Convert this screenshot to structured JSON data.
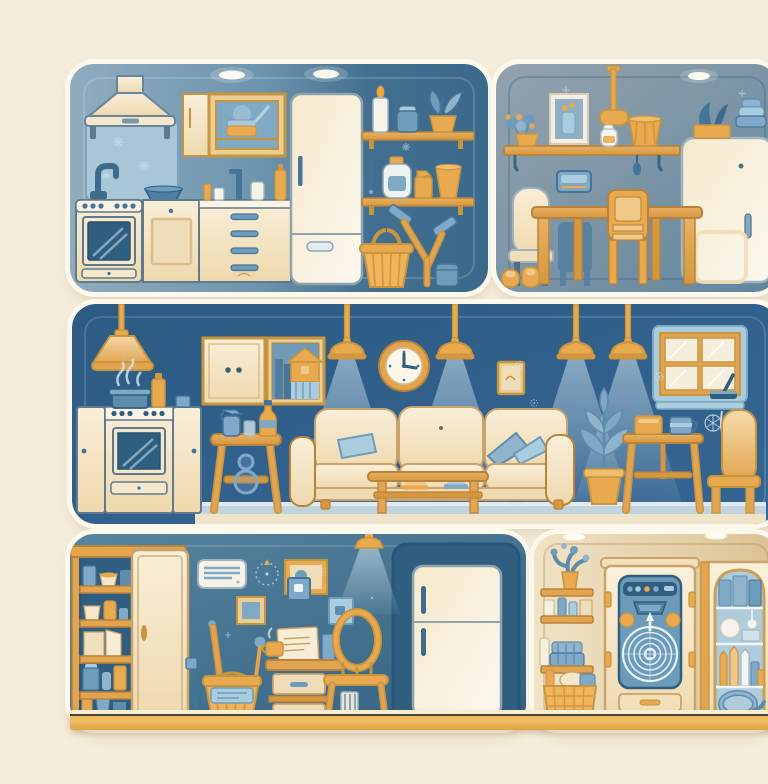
{
  "meta": {
    "type": "illustration",
    "description": "Flat vector-style illustration of home interiors in blue and amber tones, arranged as five rounded panels: a kitchen with cleaning supplies, a dining room, a large living room, a utility room with pantry and refrigerator, and a laundry storage nook."
  },
  "palette": {
    "pageBg": "#F5EDDC",
    "panelRim": "#FCF8EC",
    "kitchenBgLeft": "#8FACBF",
    "kitchenBgRight": "#3B698B",
    "diningBg": "#8C9EAB",
    "livingBg": "#2F6089",
    "utilityBg": "#44759325",
    "laundryBg": "#EDE0C2",
    "cream": "#F3E2C1",
    "creamLight": "#FAF1DE",
    "amber": "#E9A94E",
    "amberDeep": "#D6973F",
    "wood": "#DFA558",
    "blueLight": "#A9CCDE",
    "blueMid": "#7FA9C6",
    "blueDeep": "#44749A",
    "navyOutline": "#2F5E80",
    "floorAmber": "#F1BB61",
    "white": "#FDFCF7"
  },
  "panels": {
    "kitchen": {
      "title": "Kitchen with cleaning supplies",
      "objects": [
        "range hood",
        "backsplash with faucet",
        "stove with oven",
        "door cabinet",
        "drawer unit",
        "wall cabinet with glass door",
        "sponge",
        "refrigerator",
        "wall shelves",
        "candle",
        "blue jar",
        "potted plant",
        "detergent bottle",
        "spray bottle",
        "cup",
        "crossed squeegees",
        "woven basket",
        "blue canister",
        "ceiling lights"
      ]
    },
    "dining": {
      "title": "Dining room",
      "objects": [
        "pendant lamp",
        "wall shelf",
        "flower pot",
        "framed picture",
        "white jar",
        "ribbed cup",
        "blue wall box",
        "dining table",
        "upholstered chair",
        "wooden chair",
        "chair silhouette",
        "refrigerator",
        "planter on fridge",
        "folded towels",
        "slippers",
        "ceiling light"
      ]
    },
    "living": {
      "title": "Living room",
      "objects": [
        "five pendant lamps with light cones",
        "wall clock",
        "wall cabinet",
        "house shadow-box picture",
        "stove with pot and steam",
        "cleaning spray stool",
        "sofa with blue cushions",
        "coffee table with books",
        "potted plant",
        "side table with box and mug",
        "window",
        "window squeegee with drips",
        "armchair",
        "floor strip"
      ]
    },
    "utility": {
      "title": "Utility room",
      "objects": [
        "open pantry cabinet with jars and boxes",
        "cabinet door",
        "air conditioner",
        "dashed compass decoration",
        "wall frames",
        "broom",
        "mop",
        "hand brush",
        "bucket with label",
        "desk with drawers, paper and cups",
        "bentwood chair",
        "striped glass",
        "refrigerator in alcove",
        "ceiling lamp with light cone"
      ]
    },
    "laundry": {
      "title": "Laundry storage",
      "objects": [
        "wall shelves",
        "potted cactus",
        "bottles and boxes",
        "folded towels",
        "woven laundry basket",
        "washing machine in wooden cabinet",
        "drum with spiral",
        "detergent tray",
        "display cabinet with arched glass",
        "candles and bottles",
        "coiled hose",
        "ceiling lights"
      ]
    },
    "floor": {
      "title": "Shared floor strip"
    }
  }
}
